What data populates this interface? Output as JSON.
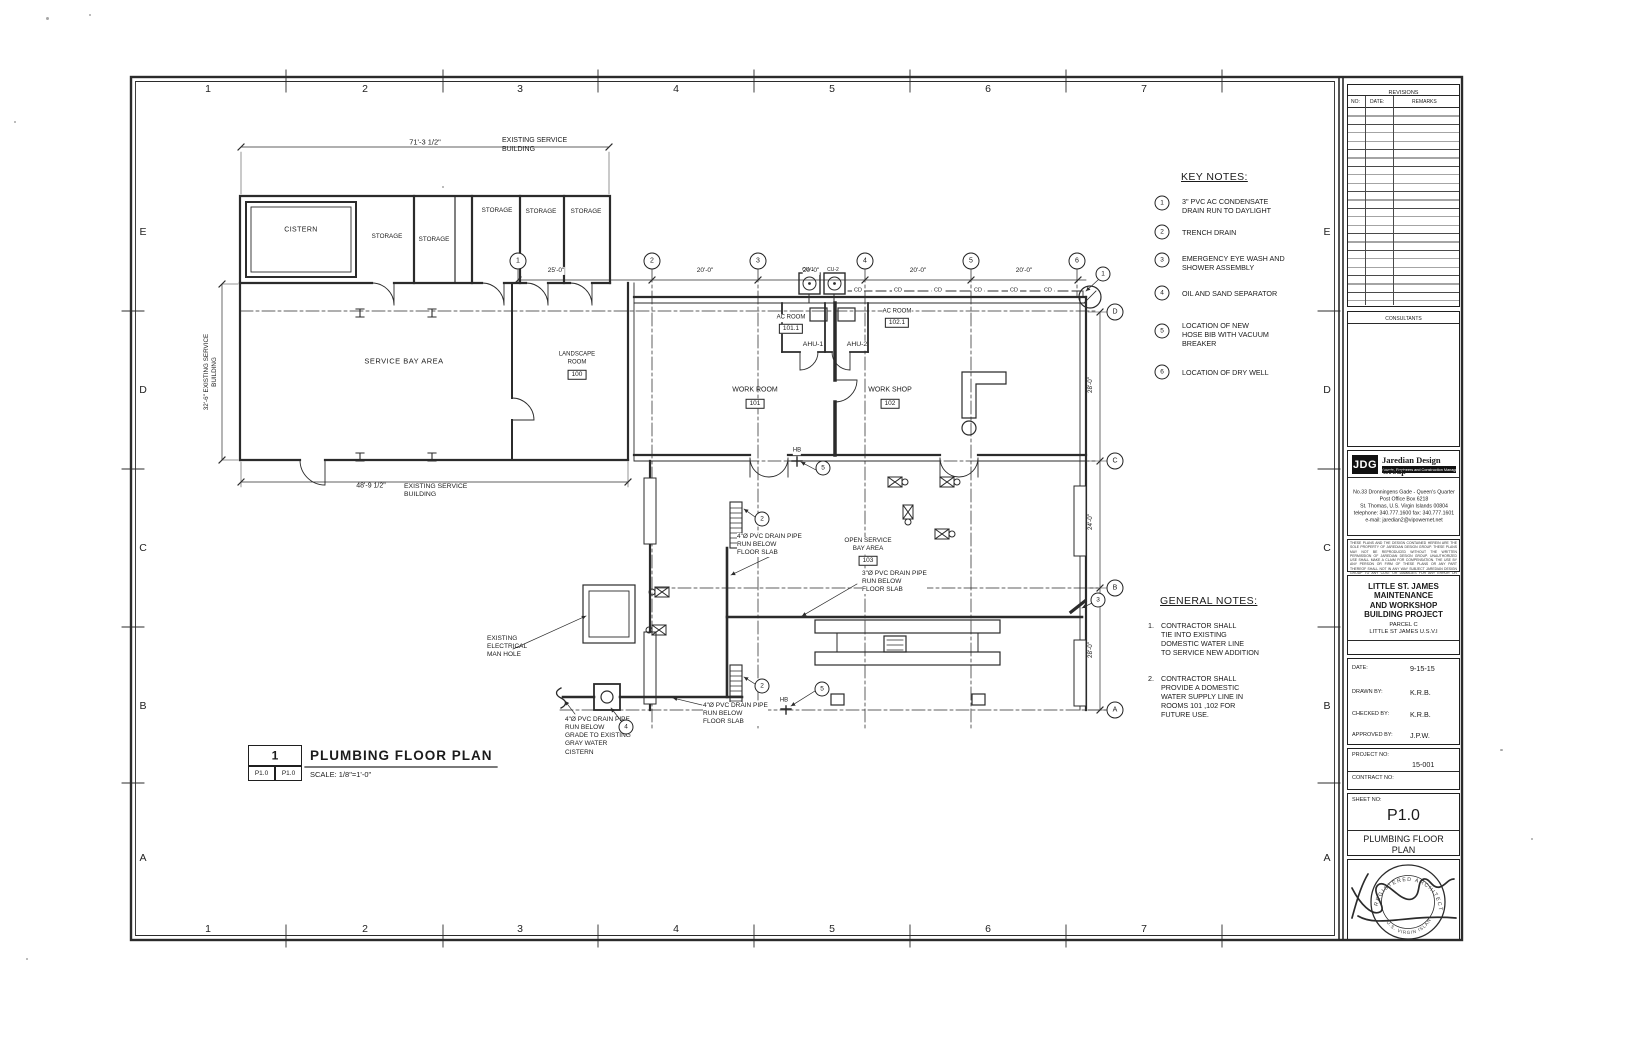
{
  "page": {
    "zone_numbers": [
      "1",
      "2",
      "3",
      "4",
      "5",
      "6",
      "7"
    ],
    "zone_letters": [
      "E",
      "D",
      "C",
      "B",
      "A"
    ]
  },
  "key_notes": {
    "title": "KEY NOTES:",
    "items": [
      {
        "num": "1",
        "text": "3\" PVC AC CONDENSATE\nDRAIN RUN TO DAYLIGHT"
      },
      {
        "num": "2",
        "text": "TRENCH DRAIN"
      },
      {
        "num": "3",
        "text": "EMERGENCY EYE WASH AND\nSHOWER ASSEMBLY"
      },
      {
        "num": "4",
        "text": "OIL AND SAND SEPARATOR"
      },
      {
        "num": "5",
        "text": "LOCATION OF NEW\nHOSE BIB WITH VACUUM\nBREAKER"
      },
      {
        "num": "6",
        "text": "LOCATION OF DRY WELL"
      }
    ]
  },
  "general_notes": {
    "title": "GENERAL  NOTES:",
    "items": [
      {
        "num": "1.",
        "text": "CONTRACTOR SHALL\nTIE INTO EXISTING\nDOMESTIC WATER LINE\nTO SERVICE NEW ADDITION"
      },
      {
        "num": "2.",
        "text": "CONTRACTOR SHALL\nPROVIDE A DOMESTIC\nWATER SUPPLY LINE IN\nROOMS  101 ,102 FOR\nFUTURE USE."
      }
    ]
  },
  "view_title": {
    "number": "1",
    "title": "PLUMBING  FLOOR PLAN",
    "ref": "P1.0",
    "scale": "SCALE:  1/8\"=1'-0\""
  },
  "plan": {
    "dims": {
      "top": "71'-3 1/2\"",
      "d25": "25'-0\"",
      "d20": "20'-0\"",
      "left": "32'-6\" EXISTING SERVICE\nBUILDING",
      "bottom": "48'-9 1/2\"",
      "r1": "28'-0\"",
      "r2": "24'-0\"",
      "r3": "28'-0\""
    },
    "notes": {
      "existing_bldg": "EXISTING SERVICE\nBUILDING",
      "pvc4": "4\"Ø PVC  DRAIN PIPE\nRUN BELOW\nFLOOR SLAB",
      "pvc3": "3\"Ø PVC  DRAIN PIPE\nRUN BELOW\nFLOOR SLAB",
      "pvc4_grade": "4\"Ø PVC  DRAIN PIPE\nRUN BELOW\nGRADE TO EXISTING\nGRAY WATER\nCISTERN",
      "manhole": "EXISTING\nELECTRICAL\nMAN HOLE",
      "hb": "HB",
      "cd": "CD"
    },
    "rooms": {
      "cistern": "CISTERN",
      "storage": "STORAGE",
      "service_bay": "SERVICE  BAY  AREA",
      "landscape": "LANDSCAPE\nROOM",
      "landscape_no": "100",
      "work_room": "WORK ROOM",
      "work_room_no": "101",
      "work_shop": "WORK SHOP",
      "work_shop_no": "102",
      "ac_room": "AC ROOM",
      "ac1_no": "101.1",
      "ac2_no": "102.1",
      "ahu1": "AHU-1",
      "ahu2": "AHU-2",
      "cu1": "CU-1",
      "cu2": "CU-2",
      "open_bay": "OPEN  SERVICE\nBAY  AREA",
      "open_bay_no": "103"
    },
    "grid": {
      "g1": "1",
      "g2": "2",
      "g3": "3",
      "g4": "4",
      "g5": "5",
      "g6": "6",
      "gD": "D",
      "gC": "C",
      "gB": "B",
      "gA": "A"
    },
    "refs": {
      "r1": "1",
      "r2": "2",
      "r3": "3",
      "r4": "4",
      "r5": "5"
    }
  },
  "title_block": {
    "revisions": {
      "title": "REVISIONS",
      "col_no": "NO:",
      "col_date": "DATE:",
      "col_remarks": "REMARKS"
    },
    "consultants_title": "CONSULTANTS",
    "firm": {
      "logo": "JDG",
      "name": "Jaredian Design Group",
      "tagline": "Architects, Engineers and Construction Managers",
      "address": "No.33 Dronningens Gade - Queen's Quarter\nPost Office Box 6218\nSt. Thomas, U.S. Virgin Islands 00804\ntelephone: 340.777.1600 fax: 340.777.1601\ne-mail: jaredian2@vipowernet.net",
      "disclaimer": "THESE PLANS AND THE DESIGN CONTAINED HEREIN ARE THE SOLE PROPERTY OF JAREDIAN DESIGN GROUP. THESE PLANS MAY NOT BE REPRODUCED WITHOUT THE WRITTEN PERMISSION OF JAREDIAN DESIGN GROUP. UNAUTHORIZED USE SHALL MAKE A CLAIM FOR COMPENSATION. THE USE BY ANY PERSON OR FIRM OF THESE PLANS OR ANY PART THEREOF SHALL NOT IN ANY WAY SUBJECT JAREDIAN DESIGN GROUP TO ANY COST OR DAMAGES FOR ANY ERROR OR OMISSION CONTAINED THEREIN."
    },
    "project": {
      "name": "LITTLE ST. JAMES\nMAINTENANCE\nAND WORKSHOP\nBUILDING PROJECT",
      "parcel": "PARCEL C",
      "location": "LITTLE ST JAMES  U.S.V.I"
    },
    "meta": {
      "date_label": "DATE:",
      "date": "9-15-15",
      "drawn_label": "DRAWN BY:",
      "drawn": "K.R.B.",
      "checked_label": "CHECKED BY:",
      "checked": "K.R.B.",
      "approved_label": "APPROVED BY:",
      "approved": "J.P.W.",
      "project_no_label": "PROJECT NO:",
      "project_no": "15-001",
      "contract_no_label": "CONTRACT NO:",
      "sheet_no_label": "SHEET NO:",
      "sheet_no": "P1.0",
      "sheet_title": "PLUMBING FLOOR\nPLAN"
    }
  },
  "stamp": {
    "arc_top": "REGISTERED ARCHITECT",
    "arc_bottom": "U.S. VIRGIN ISLANDS"
  }
}
